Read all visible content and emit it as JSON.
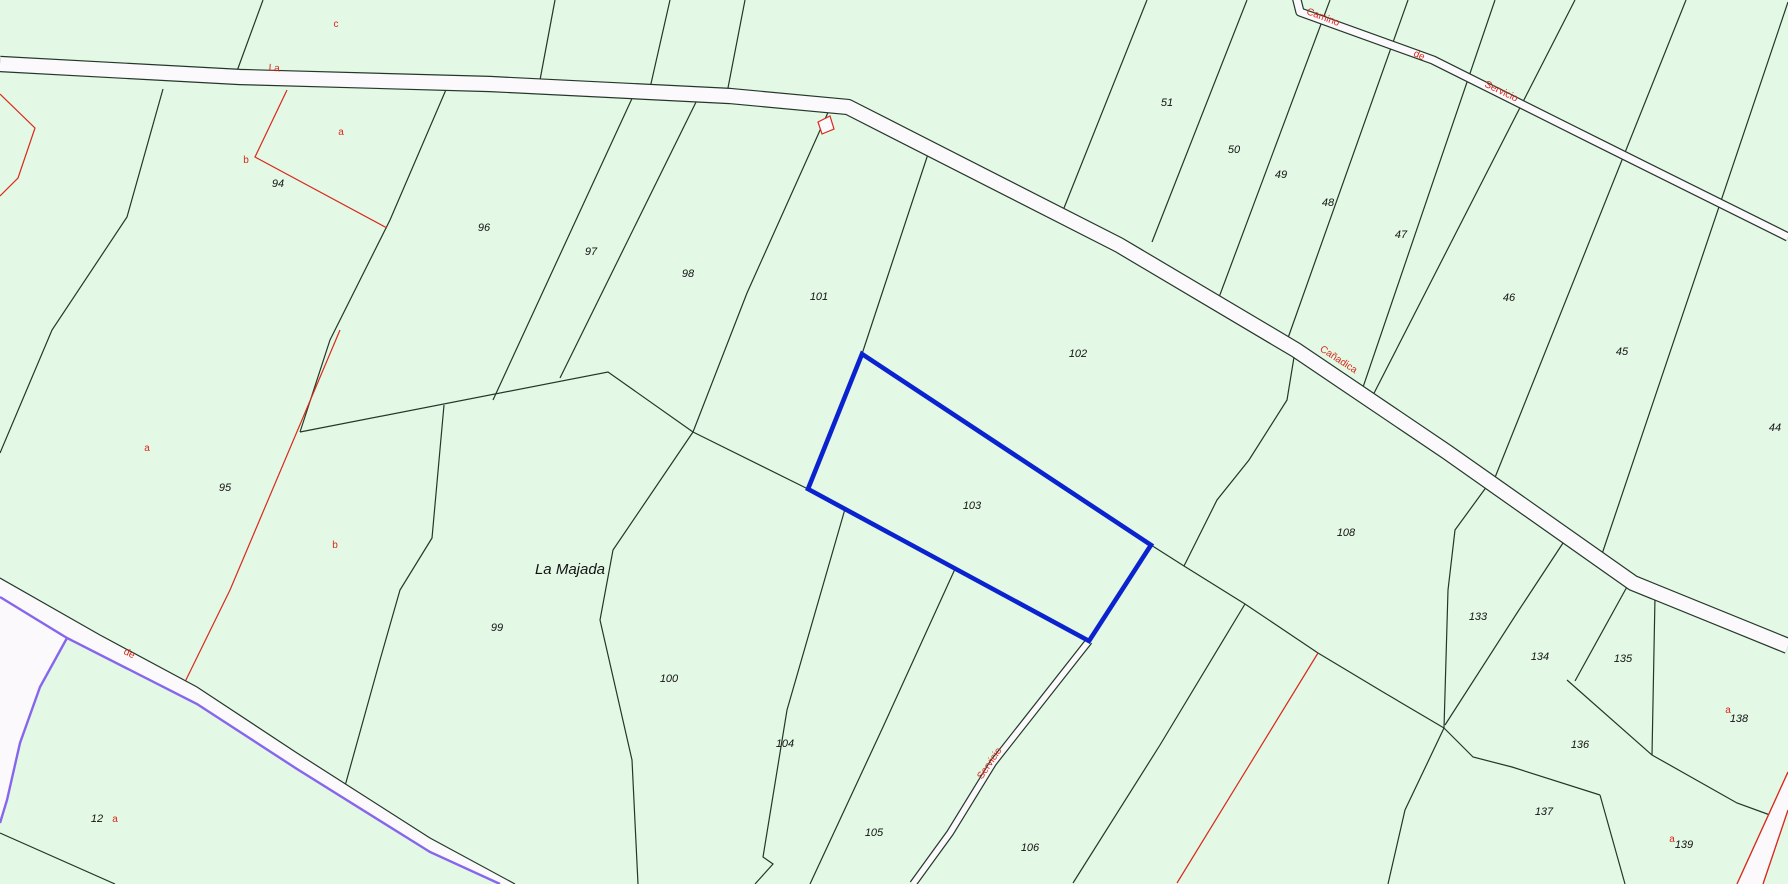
{
  "map": {
    "type": "cadastral-parcel-map",
    "place_name": "La Majada",
    "highlighted_parcel": "103",
    "colors": {
      "background": "#e3f8e5",
      "boundary": "#24382a",
      "red": "#da291c",
      "purple": "#8766ee",
      "blue_highlight": "#0b22cf",
      "road_fill": "#fbf9fb",
      "label_black": "#131313"
    },
    "place_label": {
      "text": "La Majada",
      "x": 570,
      "y": 574,
      "size": 15
    },
    "parcel_labels": [
      {
        "text": "94",
        "x": 278,
        "y": 187
      },
      {
        "text": "95",
        "x": 225,
        "y": 491
      },
      {
        "text": "96",
        "x": 484,
        "y": 231
      },
      {
        "text": "97",
        "x": 591,
        "y": 255
      },
      {
        "text": "98",
        "x": 688,
        "y": 277
      },
      {
        "text": "99",
        "x": 497,
        "y": 631
      },
      {
        "text": "100",
        "x": 669,
        "y": 682
      },
      {
        "text": "101",
        "x": 819,
        "y": 300
      },
      {
        "text": "102",
        "x": 1078,
        "y": 357
      },
      {
        "text": "103",
        "x": 972,
        "y": 509
      },
      {
        "text": "104",
        "x": 785,
        "y": 747
      },
      {
        "text": "105",
        "x": 874,
        "y": 836
      },
      {
        "text": "106",
        "x": 1030,
        "y": 851
      },
      {
        "text": "108",
        "x": 1346,
        "y": 536
      },
      {
        "text": "12",
        "x": 97,
        "y": 822
      },
      {
        "text": "44",
        "x": 1775,
        "y": 431
      },
      {
        "text": "45",
        "x": 1622,
        "y": 355
      },
      {
        "text": "46",
        "x": 1509,
        "y": 301
      },
      {
        "text": "47",
        "x": 1401,
        "y": 238
      },
      {
        "text": "48",
        "x": 1328,
        "y": 206
      },
      {
        "text": "49",
        "x": 1281,
        "y": 178
      },
      {
        "text": "50",
        "x": 1234,
        "y": 153
      },
      {
        "text": "51",
        "x": 1167,
        "y": 106
      },
      {
        "text": "133",
        "x": 1478,
        "y": 620
      },
      {
        "text": "134",
        "x": 1540,
        "y": 660
      },
      {
        "text": "135",
        "x": 1623,
        "y": 662
      },
      {
        "text": "136",
        "x": 1580,
        "y": 748
      },
      {
        "text": "137",
        "x": 1544,
        "y": 815
      },
      {
        "text": "138",
        "x": 1739,
        "y": 722
      },
      {
        "text": "139",
        "x": 1684,
        "y": 848
      }
    ],
    "subparcel_labels": [
      {
        "text": "c",
        "x": 336,
        "y": 27
      },
      {
        "text": "a",
        "x": 341,
        "y": 135
      },
      {
        "text": "b",
        "x": 246,
        "y": 163
      },
      {
        "text": "a",
        "x": 147,
        "y": 451
      },
      {
        "text": "b",
        "x": 335,
        "y": 548
      },
      {
        "text": "a",
        "x": 115,
        "y": 822
      },
      {
        "text": "a",
        "x": 1728,
        "y": 713
      },
      {
        "text": "a",
        "x": 1672,
        "y": 842
      }
    ],
    "road_name_labels": [
      {
        "text": "La",
        "x": 274,
        "y": 71,
        "rotate": 4
      },
      {
        "text": "Camino",
        "x": 1322,
        "y": 20,
        "rotate": 21
      },
      {
        "text": "de",
        "x": 1418,
        "y": 58,
        "rotate": 24
      },
      {
        "text": "Servicio",
        "x": 1500,
        "y": 94,
        "rotate": 26
      },
      {
        "text": "Cañadica",
        "x": 1337,
        "y": 362,
        "rotate": 33
      },
      {
        "text": "de",
        "x": 128,
        "y": 656,
        "rotate": 27
      },
      {
        "text": "Servicio",
        "x": 992,
        "y": 765,
        "rotate": -56
      }
    ],
    "boundary_lines": [
      [
        [
          263,
          0
        ],
        [
          237,
          71
        ]
      ],
      [
        [
          163,
          89
        ],
        [
          127,
          217
        ],
        [
          52,
          330
        ],
        [
          0,
          453
        ]
      ],
      [
        [
          448,
          85
        ],
        [
          390,
          220
        ],
        [
          330,
          340
        ],
        [
          300,
          432
        ]
      ],
      [
        [
          635,
          92
        ],
        [
          493,
          400
        ]
      ],
      [
        [
          700,
          94
        ],
        [
          560,
          378
        ]
      ],
      [
        [
          830,
          108
        ],
        [
          747,
          293
        ],
        [
          693,
          432
        ]
      ],
      [
        [
          930,
          148
        ],
        [
          862,
          354
        ]
      ],
      [
        [
          300,
          432
        ],
        [
          608,
          372
        ],
        [
          693,
          432
        ]
      ],
      [
        [
          693,
          432
        ],
        [
          613,
          550
        ],
        [
          600,
          620
        ],
        [
          632,
          760
        ],
        [
          638,
          884
        ]
      ],
      [
        [
          444,
          405
        ],
        [
          432,
          538
        ],
        [
          400,
          590
        ],
        [
          380,
          660
        ],
        [
          345,
          786
        ]
      ],
      [
        [
          693,
          432
        ],
        [
          808,
          489
        ]
      ],
      [
        [
          845,
          509
        ],
        [
          787,
          710
        ],
        [
          763,
          857
        ],
        [
          773,
          864
        ],
        [
          755,
          884
        ]
      ],
      [
        [
          955,
          569
        ],
        [
          883,
          727
        ],
        [
          810,
          884
        ]
      ],
      [
        [
          1151,
          545
        ],
        [
          1184,
          566
        ],
        [
          1245,
          604
        ],
        [
          1318,
          653
        ]
      ],
      [
        [
          1296,
          345
        ],
        [
          1287,
          400
        ],
        [
          1249,
          460
        ],
        [
          1217,
          500
        ],
        [
          1184,
          566
        ]
      ],
      [
        [
          1245,
          604
        ],
        [
          1160,
          745
        ],
        [
          1073,
          883
        ]
      ],
      [
        [
          1318,
          653
        ],
        [
          1383,
          692
        ],
        [
          1444,
          728
        ]
      ],
      [
        [
          1490,
          482
        ],
        [
          1455,
          530
        ],
        [
          1448,
          590
        ],
        [
          1444,
          728
        ]
      ],
      [
        [
          1563,
          543
        ],
        [
          1517,
          613
        ],
        [
          1445,
          725
        ]
      ],
      [
        [
          1628,
          585
        ],
        [
          1575,
          681
        ]
      ],
      [
        [
          1567,
          680
        ],
        [
          1652,
          755
        ],
        [
          1737,
          803
        ],
        [
          1770,
          815
        ]
      ],
      [
        [
          1655,
          597
        ],
        [
          1652,
          755
        ]
      ],
      [
        [
          1444,
          728
        ],
        [
          1473,
          757
        ],
        [
          1512,
          767
        ],
        [
          1600,
          795
        ]
      ],
      [
        [
          1600,
          795
        ],
        [
          1625,
          884
        ]
      ],
      [
        [
          1444,
          728
        ],
        [
          1405,
          810
        ],
        [
          1388,
          884
        ]
      ],
      [
        [
          1147,
          0
        ],
        [
          1060,
          218
        ]
      ],
      [
        [
          1247,
          0
        ],
        [
          1152,
          242
        ]
      ],
      [
        [
          1330,
          0
        ],
        [
          1218,
          300
        ]
      ],
      [
        [
          1408,
          0
        ],
        [
          1288,
          338
        ]
      ],
      [
        [
          1495,
          0
        ],
        [
          1360,
          396
        ]
      ],
      [
        [
          1575,
          0
        ],
        [
          1369,
          403
        ]
      ],
      [
        [
          1686,
          0
        ],
        [
          1494,
          480
        ]
      ],
      [
        [
          1788,
          2
        ],
        [
          1600,
          560
        ]
      ],
      [
        [
          555,
          0
        ],
        [
          540,
          80
        ]
      ],
      [
        [
          670,
          0
        ],
        [
          650,
          88
        ]
      ],
      [
        [
          745,
          0
        ],
        [
          727,
          93
        ]
      ],
      [
        [
          0,
          833
        ],
        [
          115,
          884
        ]
      ]
    ],
    "red_lines": [
      [
        [
          0,
          94
        ],
        [
          35,
          128
        ],
        [
          18,
          178
        ],
        [
          0,
          196
        ]
      ],
      [
        [
          287,
          90
        ],
        [
          255,
          157
        ],
        [
          387,
          228
        ]
      ],
      [
        [
          340,
          330
        ],
        [
          230,
          590
        ],
        [
          182,
          688
        ]
      ],
      [
        [
          1318,
          653
        ],
        [
          1177,
          883
        ]
      ],
      [
        [
          1737,
          884
        ],
        [
          1788,
          772
        ]
      ],
      [
        [
          1763,
          884
        ],
        [
          1788,
          810
        ]
      ]
    ],
    "building_symbol": [
      [
        818,
        122
      ],
      [
        830,
        116
      ],
      [
        834,
        129
      ],
      [
        822,
        134
      ]
    ],
    "roads": [
      {
        "name": "camino-la-majada-carretera",
        "center": [
          [
            0,
            64
          ],
          [
            240,
            77
          ],
          [
            490,
            84
          ],
          [
            730,
            96
          ],
          [
            848,
            107
          ],
          [
            1119,
            245
          ],
          [
            1296,
            350
          ],
          [
            1447,
            452
          ],
          [
            1633,
            583
          ],
          [
            1788,
            646
          ]
        ],
        "width": 14
      },
      {
        "name": "camino-de-servicio-ne",
        "center": [
          [
            1296,
            -4
          ],
          [
            1300,
            12
          ],
          [
            1433,
            60
          ],
          [
            1593,
            140
          ],
          [
            1788,
            237
          ]
        ],
        "width": 7
      },
      {
        "name": "camino-servicio-s",
        "center": [
          [
            1089,
            641
          ],
          [
            993,
            763
          ],
          [
            950,
            833
          ],
          [
            913,
            884
          ]
        ],
        "width": 5.5
      }
    ],
    "purple_road": {
      "band_upper": [
        [
          0,
          578
        ],
        [
          100,
          635
        ],
        [
          197,
          687
        ],
        [
          297,
          753
        ],
        [
          430,
          838
        ],
        [
          515,
          884
        ]
      ],
      "band_lower": [
        [
          0,
          597
        ],
        [
          67,
          638
        ],
        [
          197,
          704
        ],
        [
          297,
          769
        ],
        [
          430,
          852
        ],
        [
          500,
          884
        ]
      ],
      "branch_wedge": [
        [
          0,
          597
        ],
        [
          67,
          638
        ],
        [
          40,
          687
        ],
        [
          20,
          743
        ],
        [
          7,
          800
        ],
        [
          0,
          823
        ]
      ],
      "branch_edge": [
        [
          67,
          638
        ],
        [
          40,
          687
        ],
        [
          20,
          743
        ],
        [
          7,
          800
        ],
        [
          0,
          823
        ]
      ]
    },
    "red_road_band": [
      [
        1737,
        884
      ],
      [
        1788,
        772
      ],
      [
        1788,
        810
      ],
      [
        1763,
        884
      ]
    ],
    "highlighted_parcel_outline": [
      [
        862,
        354
      ],
      [
        1151,
        545
      ],
      [
        1089,
        641
      ],
      [
        808,
        489
      ]
    ]
  }
}
